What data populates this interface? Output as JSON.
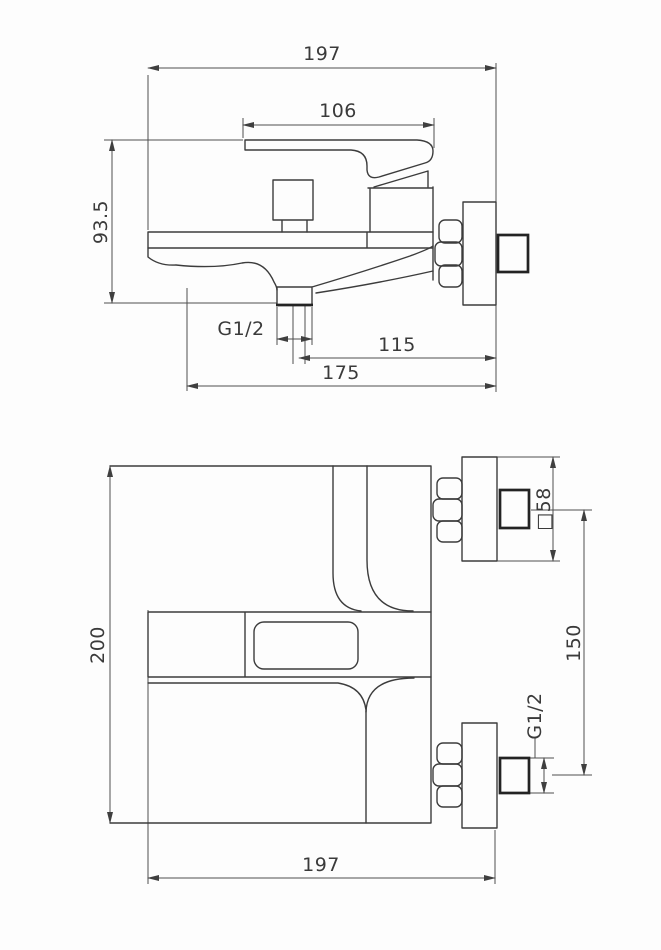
{
  "colors": {
    "background": "#fdfdfd",
    "line": "#3c3c3c",
    "thick_line": "#232323",
    "dimension_line": "#4e4e4e",
    "text": "#3a3a3a"
  },
  "top_view": {
    "dims": {
      "overall_width": "197",
      "handle_length": "106",
      "overall_height": "93.5",
      "spout_thread": "G1/2",
      "spout_center_to_wall": "115",
      "body_to_wall": "175"
    }
  },
  "front_view": {
    "dims": {
      "overall_height": "200",
      "flange_square": "□58",
      "connection_spacing": "150",
      "connection_thread": "G1/2",
      "overall_depth": "197"
    }
  }
}
